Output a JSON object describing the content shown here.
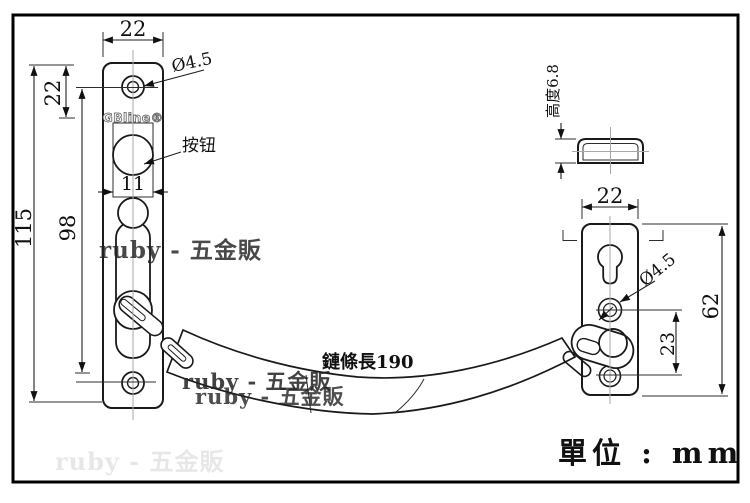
{
  "unit_label": "單位 : mm",
  "brand_logo": "GBline®",
  "chain": {
    "length_label": "鏈條長190"
  },
  "left_plate": {
    "width": "22",
    "total_height": "115",
    "slot_height": "98",
    "top_hole_offset": "22",
    "button_width": "11",
    "hole_diameter": "Ø4.5",
    "button_label": "按钮"
  },
  "cap_side_view": {
    "height_label": "高度6.8"
  },
  "right_plate": {
    "width": "22",
    "height": "62",
    "hole_spacing": "23",
    "hole_diameter": "Ø4.5"
  },
  "watermark": {
    "text": "ruby - 五金販"
  },
  "colors": {
    "line": "#1a1a1a",
    "border": "#000000",
    "centerline": "#a8a8a8",
    "watermark": "#222222",
    "background": "#ffffff"
  }
}
